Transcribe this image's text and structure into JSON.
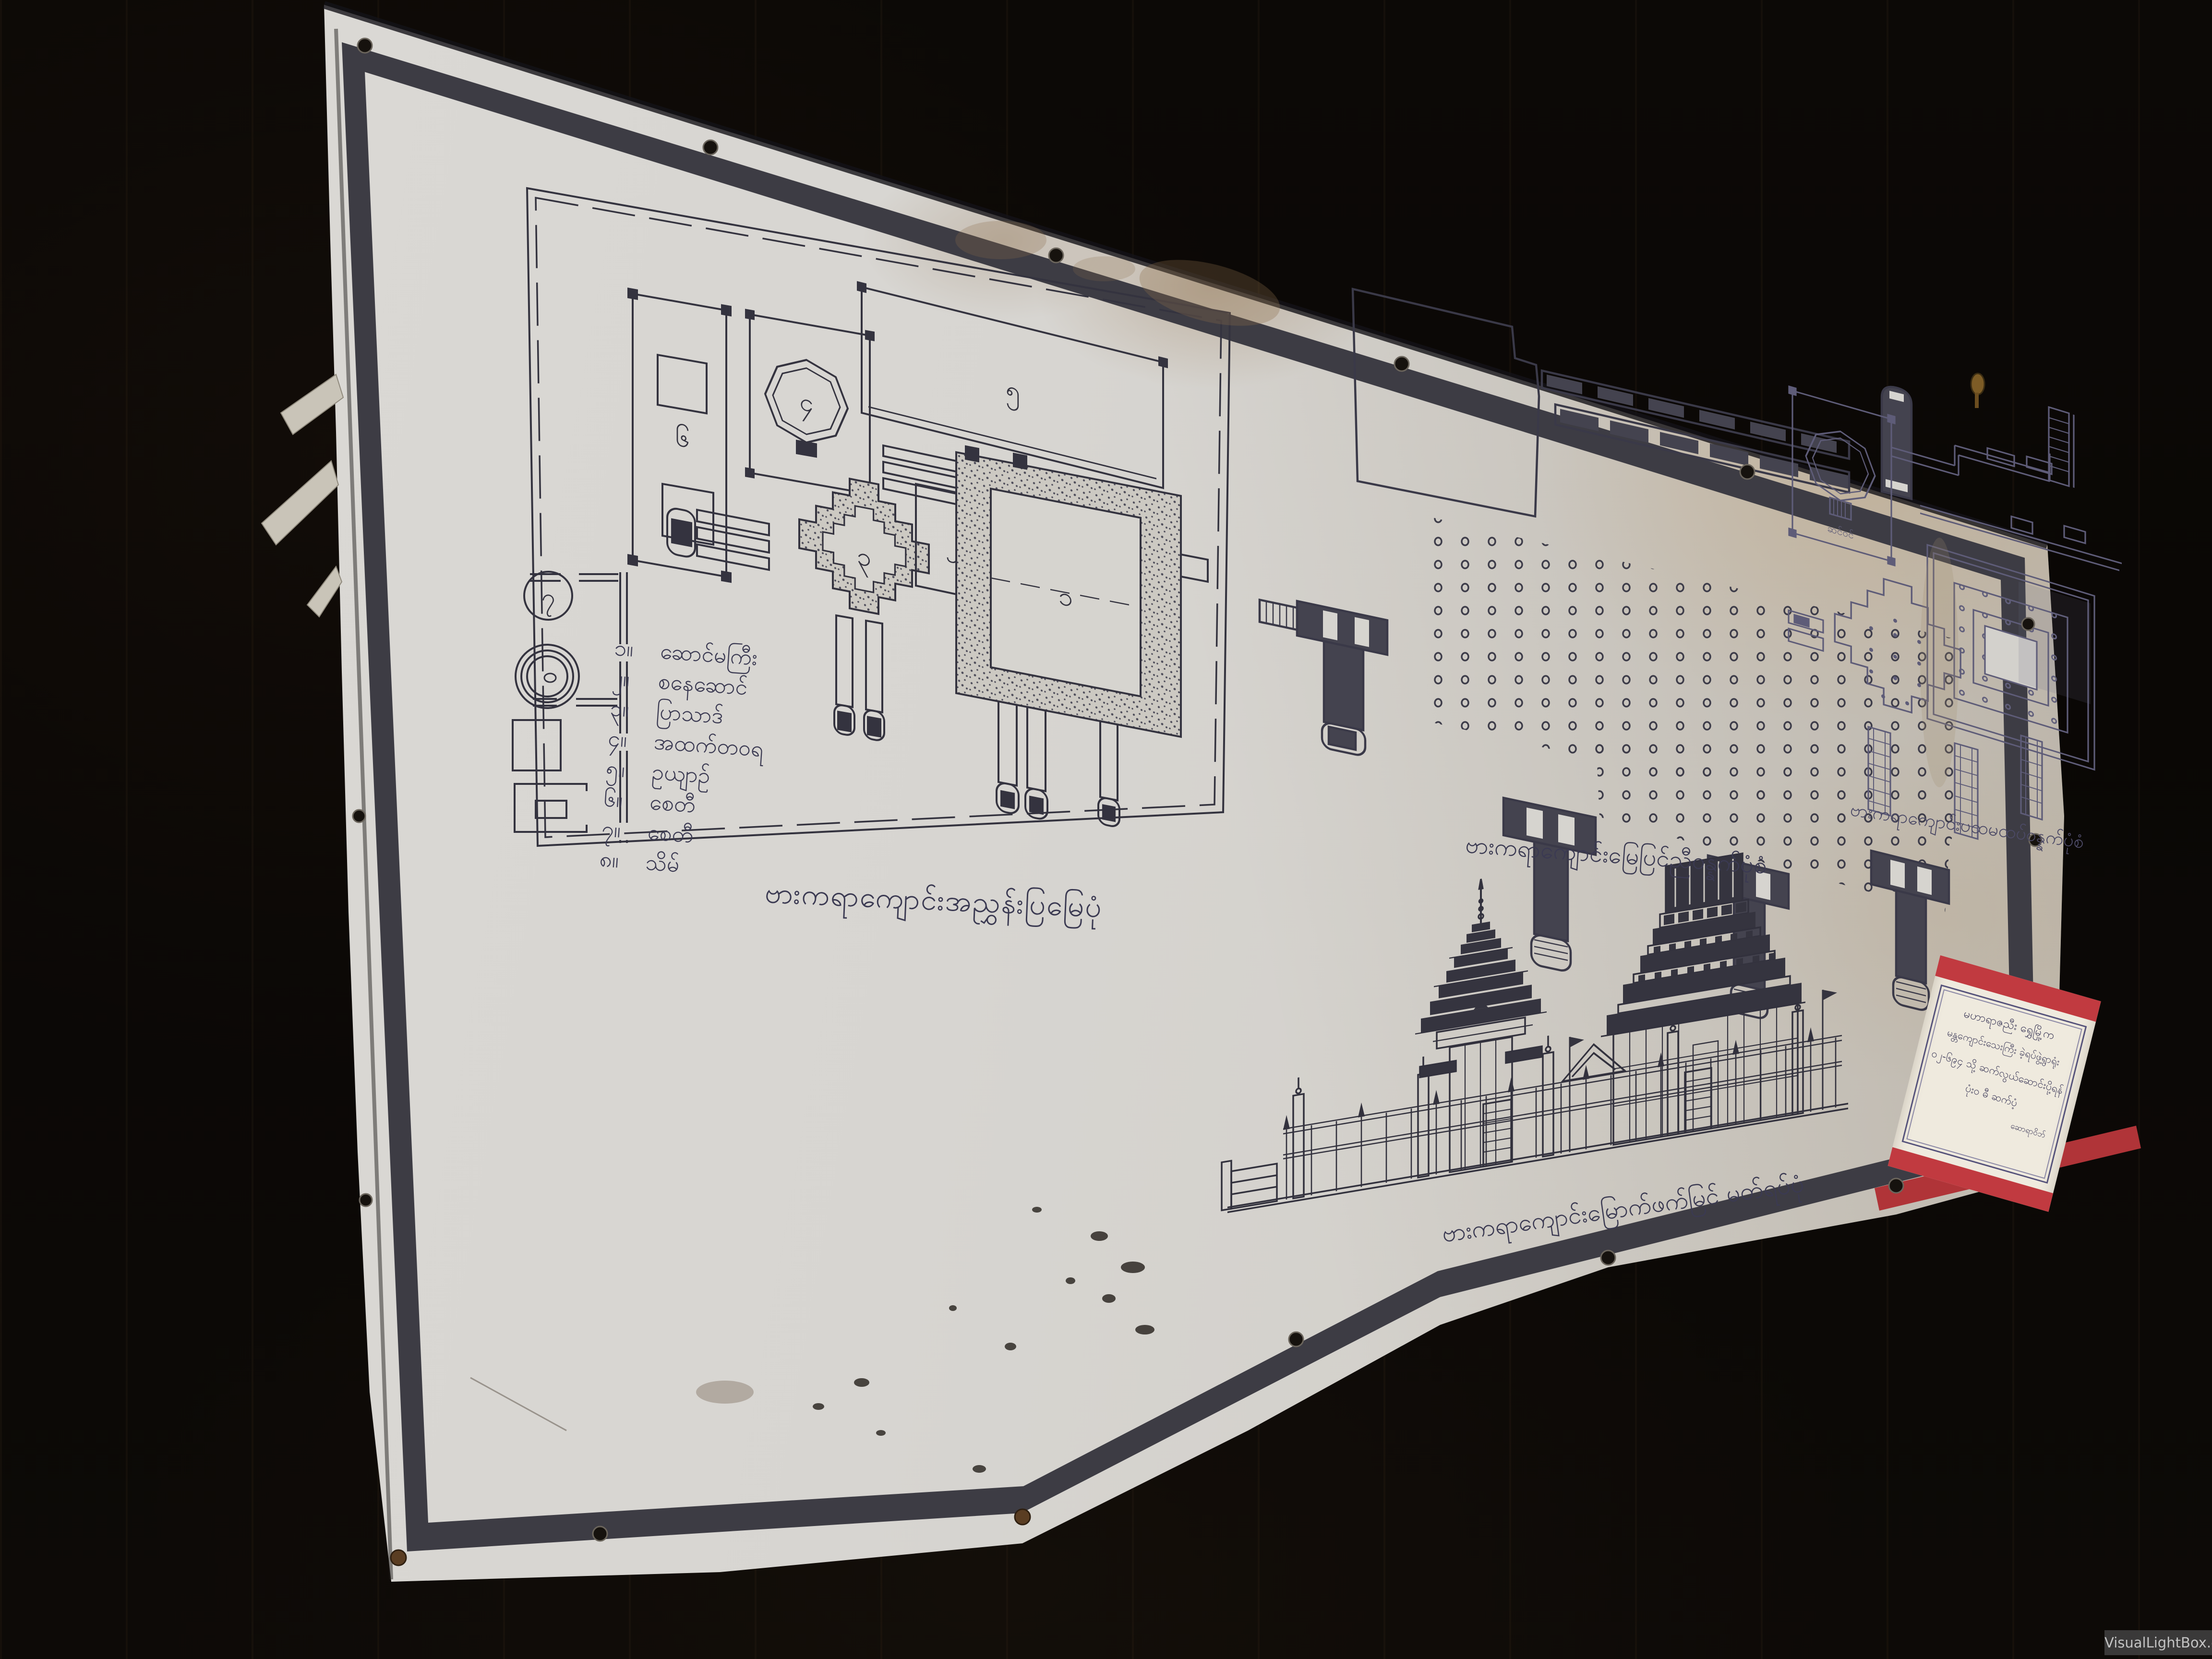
{
  "photo": {
    "watermark": "VisualLightBox.com"
  },
  "banner": {
    "title_captions": {
      "site_plan": "ဗားကရာကျောင်းအညွှန်းပြမြေပုံ",
      "ground_floor_plan": "ဗားကရာကျောင်းမြေပြင်ညီဝန္နက်ပုံစံ",
      "upper_floor_plan": "ဗားကရာကျောင်းပထမထပ်ဝန္နက်ပုံစံ",
      "elevation": "ဗားကရာကျောင်းမြောက်ဖက်မြင် မတ်ရပ်ပုံ"
    },
    "legend": {
      "items": [
        {
          "num": "၁။",
          "label": "ဆောင်မကြီး"
        },
        {
          "num": "၂။",
          "label": "စနေဆောင်"
        },
        {
          "num": "၃။",
          "label": "ပြာသာဒ်"
        },
        {
          "num": "၄။",
          "label": "အထက်တဝရ"
        },
        {
          "num": "၅။",
          "label": "ဥယျာဉ်"
        },
        {
          "num": "၆။",
          "label": "စေတီ"
        },
        {
          "num": "၇။",
          "label": "စေတီ"
        },
        {
          "num": "၈။",
          "label": "သိမ်"
        }
      ]
    },
    "plan_labels": {
      "platform": "၁",
      "saturday_hall": "၂",
      "pyatthat": "၃",
      "octagon": "၄",
      "garden": "၅",
      "stupa_enclosure": "၆",
      "stupa_circle": "၇",
      "porch": "ဆင်ဝင်"
    },
    "red_sign": {
      "lines": [
        "မဟာရာဇညီး ရွှေမြို့က",
        "မန္တကျောင်းသေးကြီး ခဲ့ရပ်ဖွဲ့ရွာရုံး",
        "၀၂-၆၉၄ သို့ ဆက်လွယ်ဆောင်းပို့ရန်",
        "ပုံးဝ ဓီ ဆက်ပံ့",
        "ဆောရာဝိဘ်"
      ]
    },
    "colors": {
      "cloth": "#d8d6d1",
      "frame_band": "#3d3c44",
      "ink": "#34333f",
      "faint_ink": "#5e5c78",
      "red": "#c13a40",
      "wood": "#0b0806"
    }
  }
}
